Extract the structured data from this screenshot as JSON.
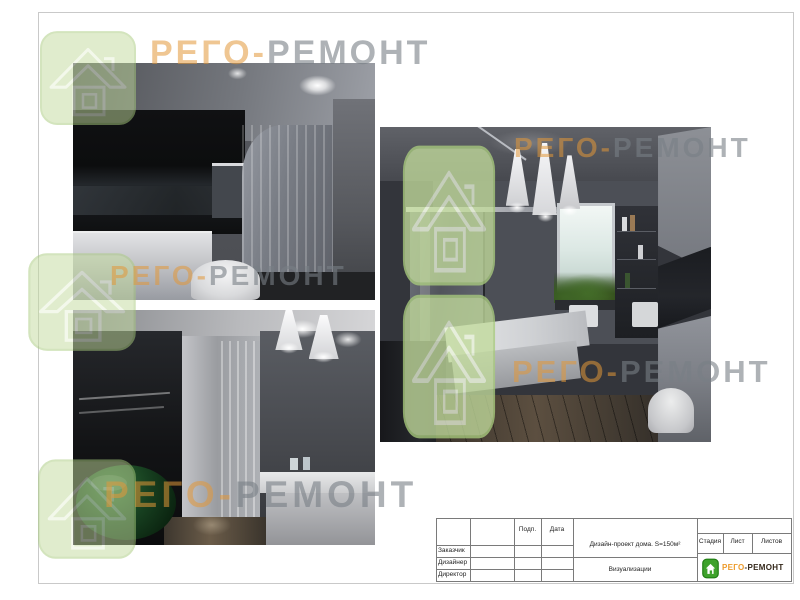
{
  "brand": {
    "word_left": "РЕГО",
    "word_sep": "-",
    "word_right": "РЕМОНТ",
    "colors": {
      "watermark_orange": "#E29838",
      "watermark_gray": "#787E85",
      "house_fill_green": "#C2DB9C",
      "logo_green": "#3EA22B",
      "logo_orange": "#ED9B2B",
      "logo_dark": "#33271A"
    }
  },
  "title_block": {
    "signature_columns": {
      "podp": "Подп.",
      "data": "Дата"
    },
    "role_rows": [
      "Заказчик",
      "Дизайнер",
      "Директор"
    ],
    "project_title": "Дизайн-проект дома.  S=150м²",
    "sheet_title": "Визуализации",
    "stage_label": "Стадия",
    "sheet_label": "Лист",
    "sheets_label": "Листов"
  },
  "renders": {
    "items": [
      {
        "name": "bathroom-render-top-left"
      },
      {
        "name": "bathroom-render-bottom-left"
      },
      {
        "name": "bathroom-render-right"
      }
    ]
  }
}
